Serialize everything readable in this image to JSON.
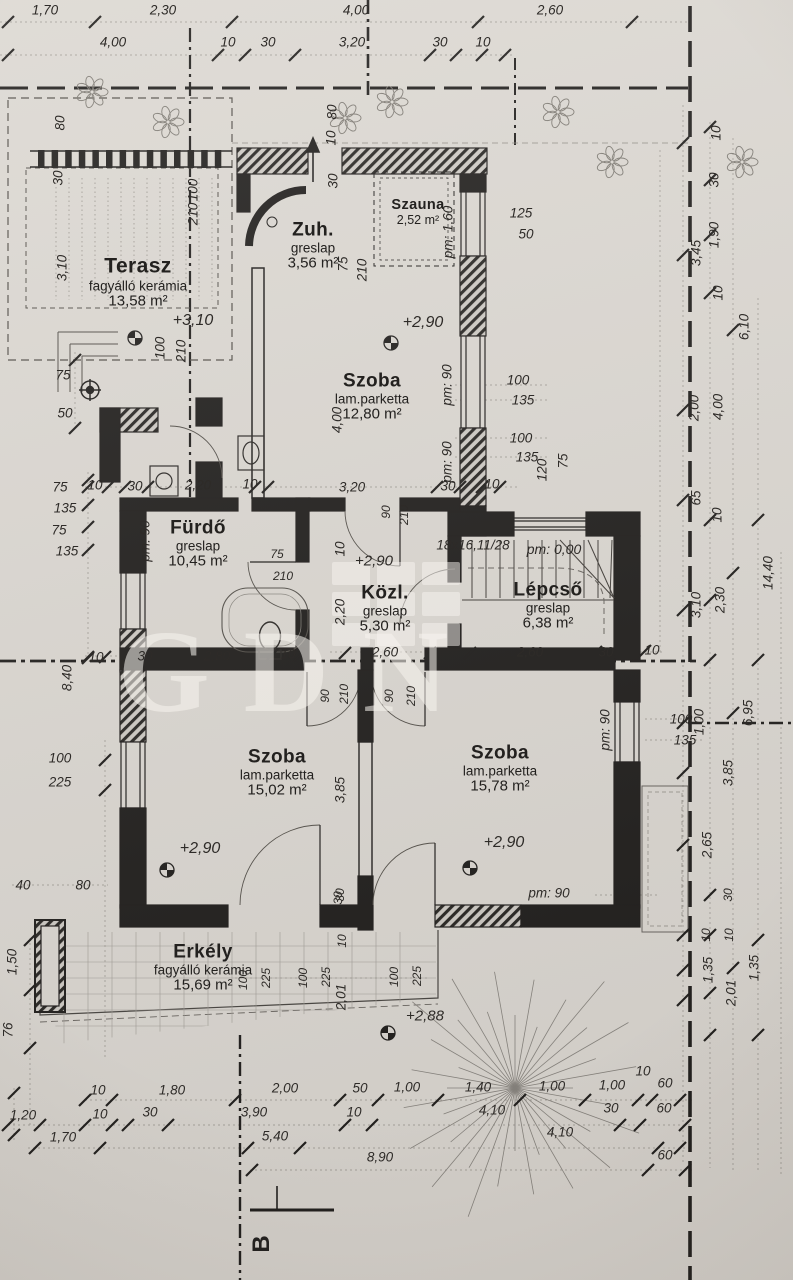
{
  "watermark": "GDN",
  "section_marker": "B",
  "rooms": [
    {
      "key": "terasz",
      "name": "Terasz",
      "material": "fagyálló kerámia",
      "area": "13,58 m²",
      "x": 138,
      "y": 282,
      "variant": "large"
    },
    {
      "key": "zuh",
      "name": "Zuh.",
      "material": "greslap",
      "area": "3,56 m²",
      "x": 313,
      "y": 246,
      "variant": ""
    },
    {
      "key": "szauna",
      "name": "Szauna",
      "material": "",
      "area": "2,52 m²",
      "x": 418,
      "y": 212,
      "variant": "small"
    },
    {
      "key": "szoba-felso",
      "name": "Szoba",
      "material": "lam.parketta",
      "area": "12,80 m²",
      "x": 372,
      "y": 397,
      "variant": ""
    },
    {
      "key": "furdo",
      "name": "Fürdő",
      "material": "greslap",
      "area": "10,45 m²",
      "x": 198,
      "y": 544,
      "variant": ""
    },
    {
      "key": "kozl",
      "name": "Közl.",
      "material": "greslap",
      "area": "5,30 m²",
      "x": 385,
      "y": 609,
      "variant": ""
    },
    {
      "key": "lepcso",
      "name": "Lépcső",
      "material": "greslap",
      "area": "6,38 m²",
      "x": 548,
      "y": 606,
      "variant": ""
    },
    {
      "key": "szoba-bal",
      "name": "Szoba",
      "material": "lam.parketta",
      "area": "15,02 m²",
      "x": 277,
      "y": 773,
      "variant": ""
    },
    {
      "key": "szoba-jobb",
      "name": "Szoba",
      "material": "lam.parketta",
      "area": "15,78 m²",
      "x": 500,
      "y": 769,
      "variant": ""
    },
    {
      "key": "erkely",
      "name": "Erkély",
      "material": "fagyálló kerámia",
      "area": "15,69 m²",
      "x": 203,
      "y": 968,
      "variant": ""
    }
  ],
  "labels": [
    {
      "t": "1,70",
      "x": 45,
      "y": 10
    },
    {
      "t": "2,30",
      "x": 163,
      "y": 10
    },
    {
      "t": "4,00",
      "x": 356,
      "y": 10
    },
    {
      "t": "2,60",
      "x": 550,
      "y": 10
    },
    {
      "t": "4,00",
      "x": 113,
      "y": 42
    },
    {
      "t": "10",
      "x": 228,
      "y": 42
    },
    {
      "t": "30",
      "x": 268,
      "y": 42
    },
    {
      "t": "3,20",
      "x": 352,
      "y": 42
    },
    {
      "t": "30",
      "x": 440,
      "y": 42
    },
    {
      "t": "10",
      "x": 483,
      "y": 42
    },
    {
      "t": "80",
      "x": 332,
      "y": 112,
      "r": 1
    },
    {
      "t": "80",
      "x": 60,
      "y": 123,
      "r": 1
    },
    {
      "t": "30",
      "x": 58,
      "y": 178,
      "r": 1
    },
    {
      "t": "100",
      "x": 193,
      "y": 190,
      "r": 1
    },
    {
      "t": "210",
      "x": 193,
      "y": 214,
      "r": 1
    },
    {
      "t": "3,10",
      "x": 62,
      "y": 268,
      "r": 1
    },
    {
      "t": "100",
      "x": 160,
      "y": 348,
      "r": 1
    },
    {
      "t": "210",
      "x": 181,
      "y": 351,
      "r": 1
    },
    {
      "t": "75",
      "x": 63,
      "y": 375
    },
    {
      "t": "50",
      "x": 65,
      "y": 413
    },
    {
      "t": "+3,10",
      "x": 193,
      "y": 321,
      "s": 16
    },
    {
      "t": "10",
      "x": 331,
      "y": 138,
      "r": 1
    },
    {
      "t": "30",
      "x": 333,
      "y": 181,
      "r": 1
    },
    {
      "t": "75",
      "x": 343,
      "y": 264,
      "r": 1
    },
    {
      "t": "210",
      "x": 362,
      "y": 270,
      "r": 1
    },
    {
      "t": "pm: 1,60",
      "x": 448,
      "y": 232,
      "r": 1
    },
    {
      "t": "125",
      "x": 521,
      "y": 213
    },
    {
      "t": "50",
      "x": 526,
      "y": 234
    },
    {
      "t": "+2,90",
      "x": 423,
      "y": 323,
      "s": 16
    },
    {
      "t": "4,00",
      "x": 337,
      "y": 420,
      "r": 1
    },
    {
      "t": "pm: 90",
      "x": 447,
      "y": 385,
      "r": 1
    },
    {
      "t": "pm: 90",
      "x": 447,
      "y": 462,
      "r": 1
    },
    {
      "t": "100",
      "x": 518,
      "y": 380
    },
    {
      "t": "135",
      "x": 523,
      "y": 400
    },
    {
      "t": "100",
      "x": 521,
      "y": 438
    },
    {
      "t": "135",
      "x": 527,
      "y": 457
    },
    {
      "t": "120",
      "x": 542,
      "y": 470,
      "r": 1
    },
    {
      "t": "75",
      "x": 563,
      "y": 461,
      "r": 1
    },
    {
      "t": "3,20",
      "x": 352,
      "y": 487
    },
    {
      "t": "30",
      "x": 448,
      "y": 486
    },
    {
      "t": "10",
      "x": 492,
      "y": 484
    },
    {
      "t": "10",
      "x": 95,
      "y": 485
    },
    {
      "t": "30",
      "x": 135,
      "y": 486
    },
    {
      "t": "2,20",
      "x": 198,
      "y": 485
    },
    {
      "t": "10",
      "x": 250,
      "y": 484
    },
    {
      "t": "75",
      "x": 60,
      "y": 487
    },
    {
      "t": "135",
      "x": 65,
      "y": 508
    },
    {
      "t": "75",
      "x": 59,
      "y": 530
    },
    {
      "t": "135",
      "x": 67,
      "y": 551
    },
    {
      "t": "pm: 90",
      "x": 145,
      "y": 541,
      "r": 1
    },
    {
      "t": "75",
      "x": 277,
      "y": 554,
      "s": 12
    },
    {
      "t": "210",
      "x": 283,
      "y": 576,
      "s": 12
    },
    {
      "t": "90",
      "x": 386,
      "y": 512,
      "r": 1,
      "s": 12
    },
    {
      "t": "210",
      "x": 404,
      "y": 515,
      "r": 1,
      "s": 12
    },
    {
      "t": "10",
      "x": 340,
      "y": 549,
      "r": 1
    },
    {
      "t": "+2,90",
      "x": 374,
      "y": 561,
      "s": 15
    },
    {
      "t": "2,20",
      "x": 340,
      "y": 612,
      "r": 1
    },
    {
      "t": "18x16,11/28",
      "x": 473,
      "y": 545,
      "s": 13.5
    },
    {
      "t": "pm: 0,00",
      "x": 554,
      "y": 549,
      "s": 14
    },
    {
      "t": "10",
      "x": 96,
      "y": 657
    },
    {
      "t": "30",
      "x": 145,
      "y": 656
    },
    {
      "t": "2,80",
      "x": 217,
      "y": 656
    },
    {
      "t": "10",
      "x": 288,
      "y": 654
    },
    {
      "t": "2,60",
      "x": 385,
      "y": 652
    },
    {
      "t": "2,60",
      "x": 530,
      "y": 652
    },
    {
      "t": "30",
      "x": 606,
      "y": 652
    },
    {
      "t": "10",
      "x": 652,
      "y": 650
    },
    {
      "t": "90",
      "x": 325,
      "y": 696,
      "r": 1,
      "s": 12
    },
    {
      "t": "210",
      "x": 344,
      "y": 694,
      "r": 1,
      "s": 12
    },
    {
      "t": "90",
      "x": 389,
      "y": 696,
      "r": 1,
      "s": 12
    },
    {
      "t": "210",
      "x": 411,
      "y": 696,
      "r": 1,
      "s": 12
    },
    {
      "t": "8,40",
      "x": 67,
      "y": 678,
      "r": 1
    },
    {
      "t": "100",
      "x": 60,
      "y": 758
    },
    {
      "t": "225",
      "x": 60,
      "y": 782
    },
    {
      "t": "3,85",
      "x": 340,
      "y": 790,
      "r": 1
    },
    {
      "t": "+2,90",
      "x": 200,
      "y": 849,
      "s": 16
    },
    {
      "t": "+2,90",
      "x": 504,
      "y": 843,
      "s": 16
    },
    {
      "t": "30",
      "x": 340,
      "y": 895,
      "r": 1,
      "s": 12
    },
    {
      "t": "pm: 90",
      "x": 605,
      "y": 730,
      "r": 1
    },
    {
      "t": "pm: 90",
      "x": 549,
      "y": 893
    },
    {
      "t": "100",
      "x": 681,
      "y": 719
    },
    {
      "t": "135",
      "x": 685,
      "y": 740
    },
    {
      "t": "40",
      "x": 23,
      "y": 885
    },
    {
      "t": "80",
      "x": 83,
      "y": 885
    },
    {
      "t": "30",
      "x": 338,
      "y": 898,
      "r": 1,
      "s": 12
    },
    {
      "t": "10",
      "x": 342,
      "y": 941,
      "r": 1,
      "s": 12
    },
    {
      "t": "100",
      "x": 243,
      "y": 980,
      "r": 1,
      "s": 12
    },
    {
      "t": "225",
      "x": 266,
      "y": 978,
      "r": 1,
      "s": 12
    },
    {
      "t": "100",
      "x": 303,
      "y": 978,
      "r": 1,
      "s": 12
    },
    {
      "t": "225",
      "x": 326,
      "y": 977,
      "r": 1,
      "s": 12
    },
    {
      "t": "2,01",
      "x": 341,
      "y": 997,
      "r": 1
    },
    {
      "t": "100",
      "x": 394,
      "y": 977,
      "r": 1,
      "s": 12
    },
    {
      "t": "225",
      "x": 417,
      "y": 976,
      "r": 1,
      "s": 12
    },
    {
      "t": "+2,88",
      "x": 425,
      "y": 1016,
      "s": 15
    },
    {
      "t": "1,50",
      "x": 12,
      "y": 962,
      "r": 1
    },
    {
      "t": "76",
      "x": 8,
      "y": 1030,
      "r": 1
    },
    {
      "t": "10",
      "x": 716,
      "y": 133,
      "r": 1
    },
    {
      "t": "30",
      "x": 714,
      "y": 180,
      "r": 1
    },
    {
      "t": "1,90",
      "x": 714,
      "y": 235,
      "r": 1
    },
    {
      "t": "3,45",
      "x": 696,
      "y": 253,
      "r": 1
    },
    {
      "t": "10",
      "x": 718,
      "y": 293,
      "r": 1
    },
    {
      "t": "6,10",
      "x": 744,
      "y": 327,
      "r": 1
    },
    {
      "t": "2,00",
      "x": 694,
      "y": 408,
      "r": 1
    },
    {
      "t": "4,00",
      "x": 718,
      "y": 407,
      "r": 1
    },
    {
      "t": "65",
      "x": 696,
      "y": 498,
      "r": 1
    },
    {
      "t": "10",
      "x": 717,
      "y": 515,
      "r": 1
    },
    {
      "t": "14,40",
      "x": 768,
      "y": 573,
      "r": 1
    },
    {
      "t": "3,10",
      "x": 696,
      "y": 605,
      "r": 1
    },
    {
      "t": "2,30",
      "x": 720,
      "y": 600,
      "r": 1
    },
    {
      "t": "6,95",
      "x": 748,
      "y": 713,
      "r": 1
    },
    {
      "t": "1,00",
      "x": 699,
      "y": 722,
      "r": 1
    },
    {
      "t": "3,85",
      "x": 728,
      "y": 773,
      "r": 1
    },
    {
      "t": "2,65",
      "x": 707,
      "y": 845,
      "r": 1
    },
    {
      "t": "30",
      "x": 728,
      "y": 895,
      "r": 1,
      "s": 12
    },
    {
      "t": "10",
      "x": 706,
      "y": 935,
      "r": 1,
      "s": 12
    },
    {
      "t": "10",
      "x": 729,
      "y": 935,
      "r": 1,
      "s": 12
    },
    {
      "t": "1,35",
      "x": 708,
      "y": 970,
      "r": 1
    },
    {
      "t": "2,01",
      "x": 731,
      "y": 993,
      "r": 1
    },
    {
      "t": "1,35",
      "x": 754,
      "y": 968,
      "r": 1
    },
    {
      "t": "10",
      "x": 98,
      "y": 1090
    },
    {
      "t": "1,80",
      "x": 172,
      "y": 1090
    },
    {
      "t": "2,00",
      "x": 285,
      "y": 1088
    },
    {
      "t": "50",
      "x": 360,
      "y": 1088
    },
    {
      "t": "1,00",
      "x": 407,
      "y": 1087
    },
    {
      "t": "1,40",
      "x": 478,
      "y": 1087
    },
    {
      "t": "1,00",
      "x": 552,
      "y": 1086
    },
    {
      "t": "1,00",
      "x": 612,
      "y": 1085
    },
    {
      "t": "10",
      "x": 643,
      "y": 1071
    },
    {
      "t": "60",
      "x": 665,
      "y": 1083
    },
    {
      "t": "1,20",
      "x": 23,
      "y": 1115
    },
    {
      "t": "10",
      "x": 100,
      "y": 1114
    },
    {
      "t": "30",
      "x": 150,
      "y": 1112
    },
    {
      "t": "3,90",
      "x": 254,
      "y": 1112
    },
    {
      "t": "10",
      "x": 354,
      "y": 1112
    },
    {
      "t": "4,10",
      "x": 492,
      "y": 1110
    },
    {
      "t": "30",
      "x": 611,
      "y": 1108
    },
    {
      "t": "60",
      "x": 664,
      "y": 1108
    },
    {
      "t": "1,70",
      "x": 63,
      "y": 1137
    },
    {
      "t": "5,40",
      "x": 275,
      "y": 1136
    },
    {
      "t": "4,10",
      "x": 560,
      "y": 1132
    },
    {
      "t": "8,90",
      "x": 380,
      "y": 1157
    },
    {
      "t": "60",
      "x": 665,
      "y": 1155
    }
  ]
}
